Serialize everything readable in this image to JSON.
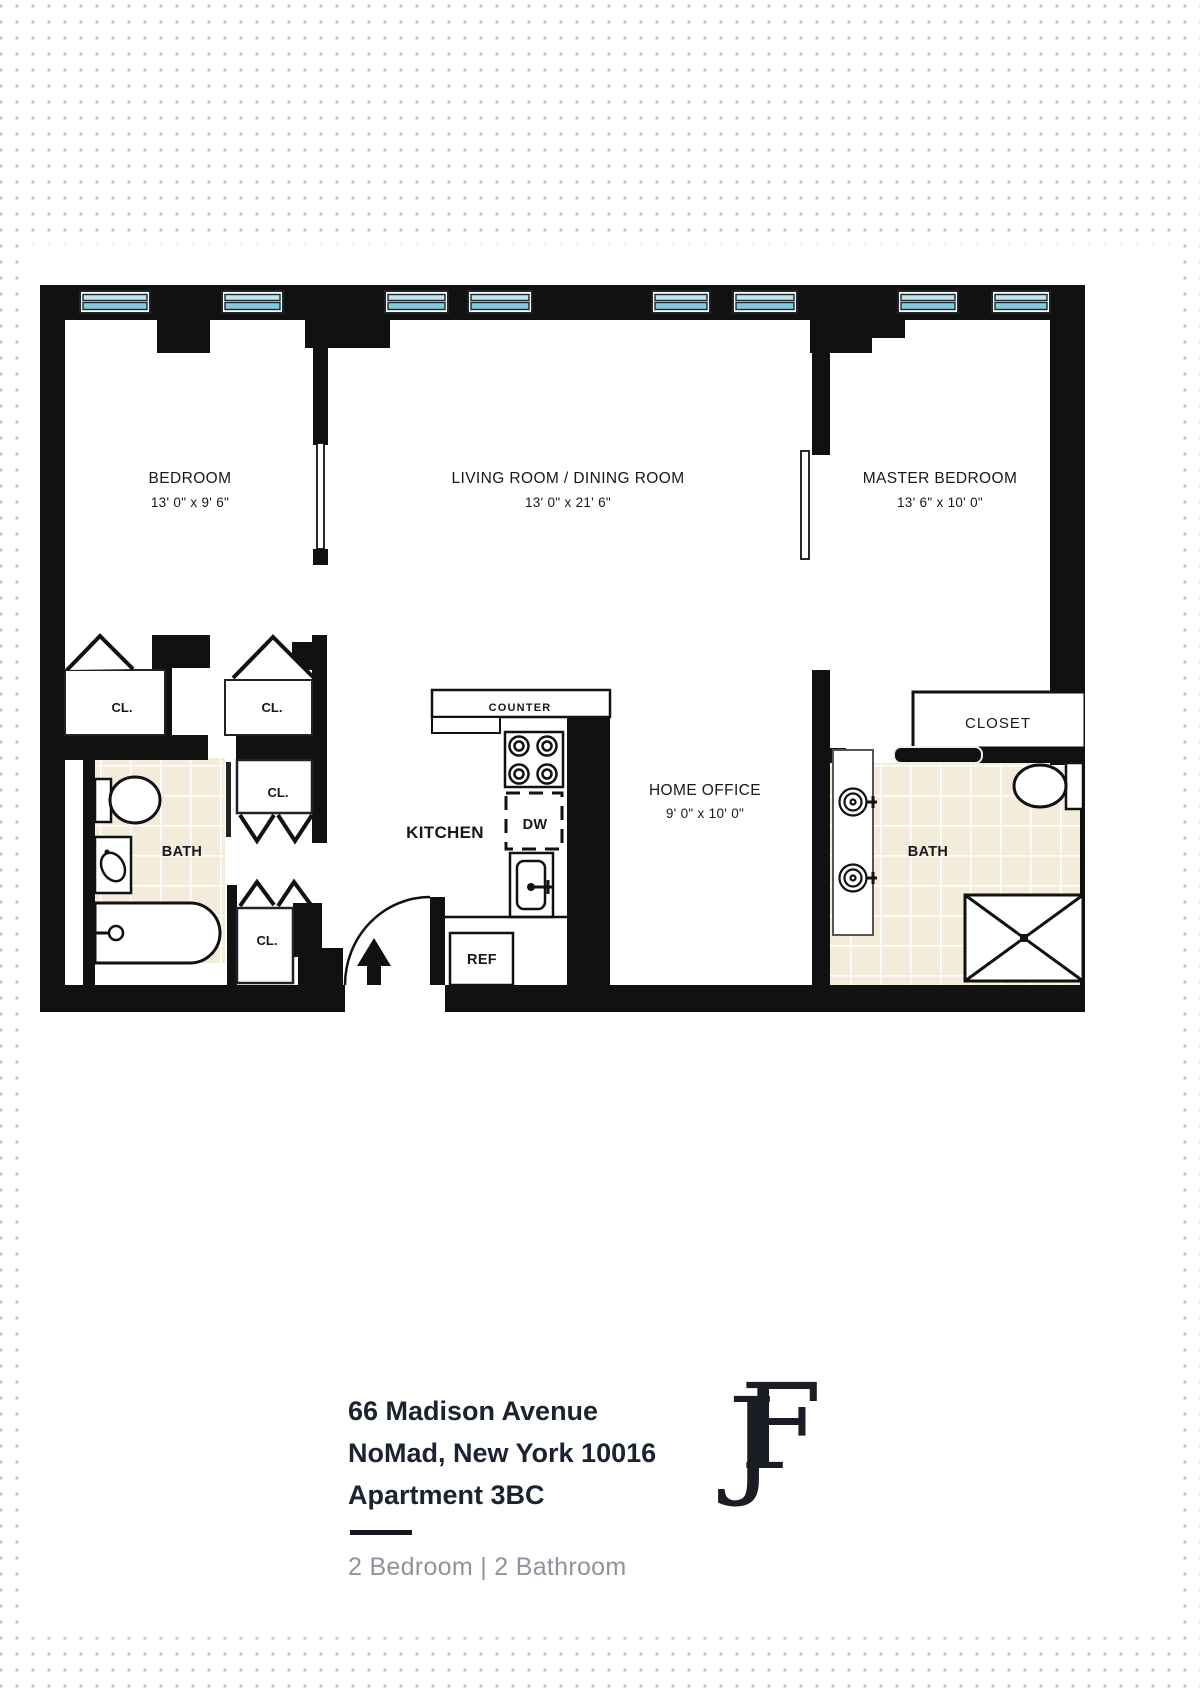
{
  "plan": {
    "bedroom_name": "BEDROOM",
    "bedroom_dims": "13' 0\" x 9' 6\"",
    "living_name": "LIVING ROOM / DINING ROOM",
    "living_dims": "13' 0\" x 21' 6\"",
    "master_name": "MASTER BEDROOM",
    "master_dims": "13' 6\" x 10' 0\"",
    "office_name": "HOME OFFICE",
    "office_dims": "9' 0\" x 10' 0\"",
    "kitchen": "KITCHEN",
    "counter": "COUNTER",
    "dw": "DW",
    "ref": "REF",
    "bath": "BATH",
    "closet": "CLOSET",
    "cl": "CL.",
    "colors": {
      "wall": "#111111",
      "window_glass": "#85c9da",
      "window_glass_light": "#bfe5ee",
      "tile": "#f4ecdb"
    }
  },
  "footer": {
    "address_line1": "66 Madison Avenue",
    "address_line2": "NoMad, New York 10016",
    "address_line3": "Apartment 3BC",
    "summary": "2 Bedroom | 2 Bathroom",
    "logo": "JF"
  }
}
